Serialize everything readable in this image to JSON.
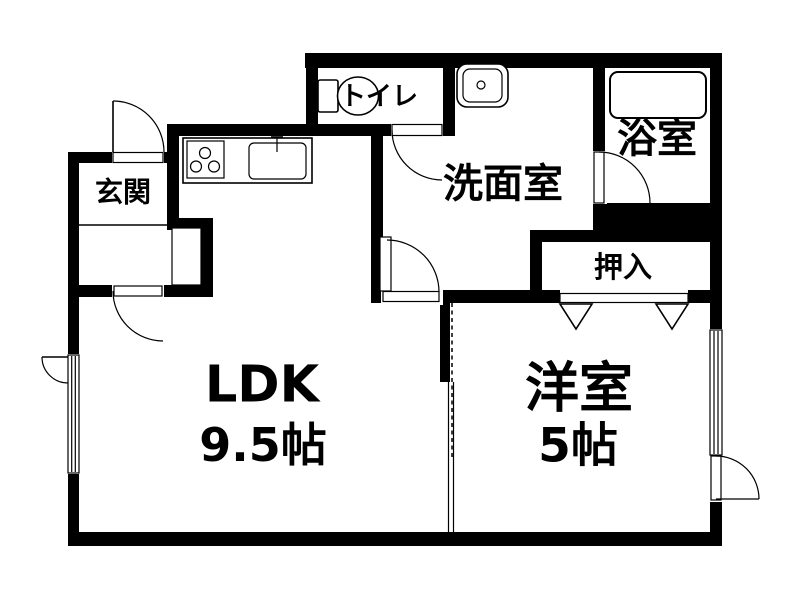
{
  "colors": {
    "wall": "#000000",
    "floor": "#ffffff",
    "line": "#000000"
  },
  "rooms": {
    "genkan": {
      "label": "玄関"
    },
    "toilet": {
      "label": "トイレ"
    },
    "washroom": {
      "label": "洗面室"
    },
    "bathroom": {
      "label": "浴室"
    },
    "closet": {
      "label": "押入"
    },
    "ldk": {
      "label": "LDK",
      "size": "9.5帖"
    },
    "western": {
      "label": "洋室",
      "size": "5帖"
    }
  },
  "fixtures": {
    "toilet_bowl": "toilet-bowl",
    "washbasin": "washbasin",
    "bathtub": "bathtub",
    "stove": "gas-stove",
    "kitchen_sink": "kitchen-sink"
  }
}
